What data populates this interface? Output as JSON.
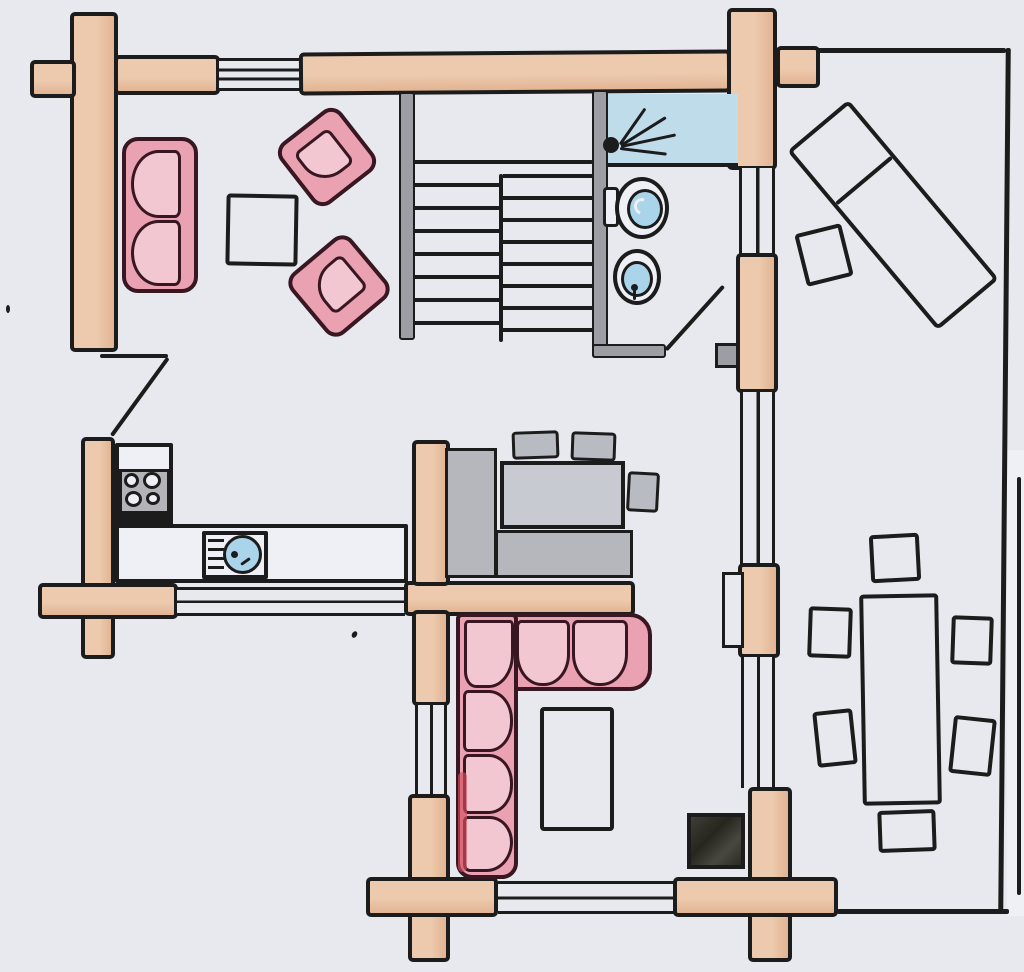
{
  "palette": {
    "paper": "#e7e9ef",
    "paper-bright": "#eef0f5",
    "ink": "#1c1c1c",
    "log": "#edcaae",
    "log-shade": "#e2b493",
    "gray-wall": "#9d9da4",
    "stove-gray": "#b4b4b8",
    "table-gray": "#c8cad1",
    "bench-gray": "#b5b7bd",
    "stool-gray": "#b9bbc2",
    "sofa-pink": "#eaa2b2",
    "cushion-pink": "#f3c7d1",
    "sofa-border": "#391722",
    "accent-red": "#d24f5e",
    "water-blue": "#a9d4e9",
    "shower-blue": "#bfdcea",
    "fireplace-dark": "#32322c"
  },
  "floor_plan": {
    "style": "hand-drawn colored-pencil floor plan of a log house, no text labels",
    "walls": {
      "exterior": "tan log walls with crossed corner joints",
      "interior": "vertical log partition with three windows separating main house from terrace",
      "windows": [
        "top wall",
        "kitchen south wall",
        "family-room south wall",
        "central wall",
        "east partition x3"
      ]
    },
    "rooms": [
      {
        "name": "living-room",
        "position": "top-left",
        "furniture": [
          "pink two-seat sofa",
          "square coffee table",
          "two pink armchairs set diagonally"
        ]
      },
      {
        "name": "staircase",
        "position": "top-center",
        "detail": "two parallel flights with ~8 treads each and upper landing"
      },
      {
        "name": "bathroom",
        "position": "top-center-right",
        "furniture": [
          "blue shower with shower head",
          "toilet",
          "washbasin"
        ],
        "door": "swing door at bottom-right"
      },
      {
        "name": "kitchen",
        "position": "middle-left",
        "furniture": [
          "L-shaped white counter",
          "4-burner stove",
          "round sink with drainer"
        ]
      },
      {
        "name": "dining-nook",
        "position": "center",
        "furniture": [
          "gray table",
          "L-shaped gray bench",
          "3 gray stools"
        ]
      },
      {
        "name": "family-room",
        "position": "bottom-center",
        "furniture": [
          "pink corner sofa",
          "white coffee table",
          "black fireplace stove"
        ]
      },
      {
        "name": "terrace",
        "position": "right-wing",
        "furniture": [
          "sun lounger rotated diagonally",
          "small side table",
          "long dining table",
          "6 chairs"
        ],
        "boundary": "thin pen line with opening on right edge"
      },
      {
        "name": "entrance",
        "position": "left wall between living room and kitchen",
        "detail": "door with swing line"
      }
    ]
  }
}
